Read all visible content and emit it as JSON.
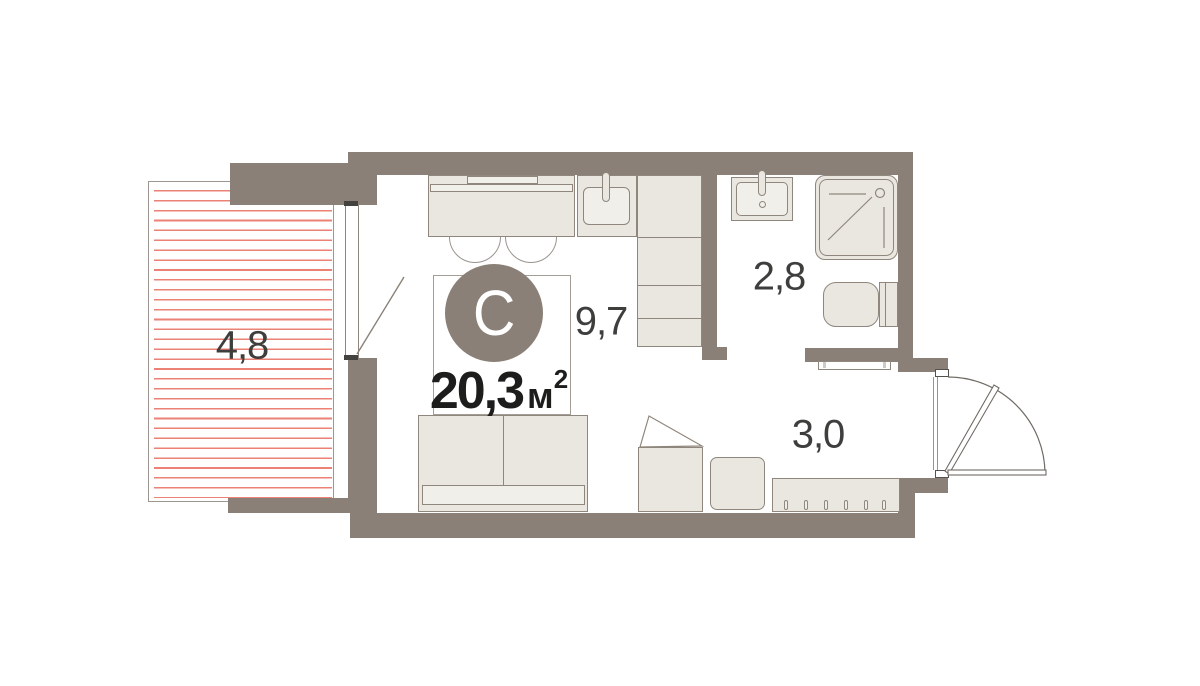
{
  "plan": {
    "unit_label": "С",
    "total_area": {
      "value": "20,3",
      "unit": "м",
      "sup": "2"
    },
    "rooms": [
      {
        "name": "balcony",
        "area": "4,8"
      },
      {
        "name": "living-kitchen",
        "area": "9,7"
      },
      {
        "name": "bathroom",
        "area": "2,8"
      },
      {
        "name": "hallway",
        "area": "3,0"
      }
    ],
    "colors": {
      "wall": "#8a8077",
      "furniture_fill": "#eae7e1",
      "furniture_stroke": "#8f877d",
      "hatch": "#ec8176",
      "text_dark": "#1d1d1b",
      "text_label": "#3e3e3c"
    }
  }
}
